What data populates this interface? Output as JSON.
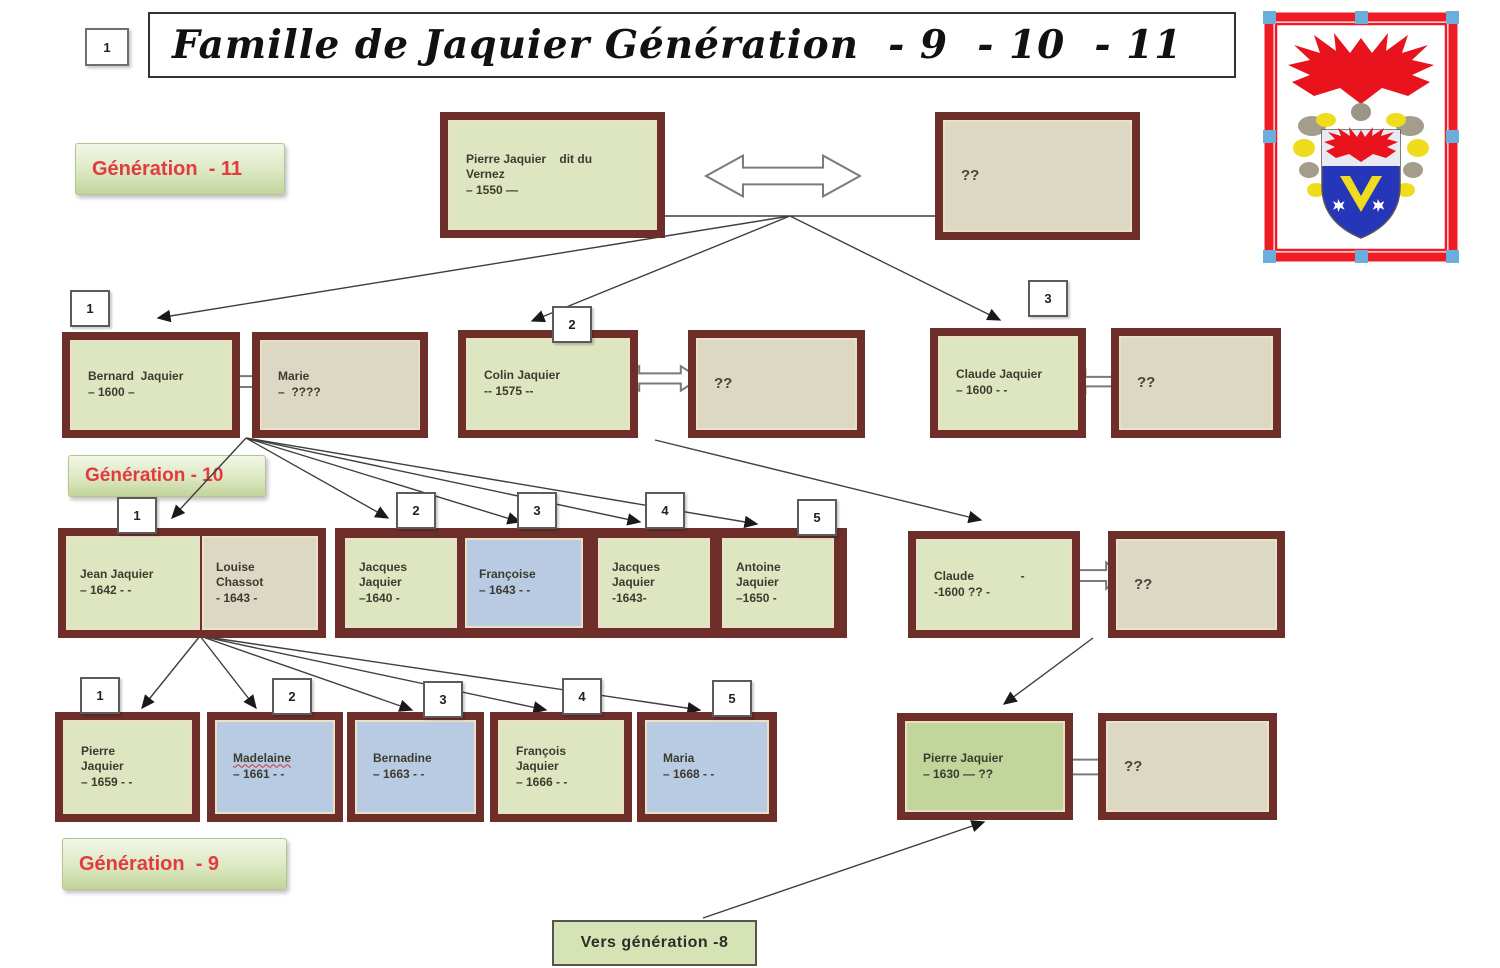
{
  "header": {
    "marker": "1",
    "title": "Famille de Jaquier Génération  - 9  - 10  - 11"
  },
  "generation_labels": {
    "gen11": "Génération  - 11",
    "gen10": "Génération - 10",
    "gen9": "Génération  - 9"
  },
  "footer": {
    "to_next_generation": "Vers génération -8"
  },
  "badges": {
    "gen10_couples": [
      "1",
      "2",
      "3"
    ],
    "gen10_children": [
      "1",
      "2",
      "3",
      "4",
      "5"
    ],
    "gen9_children": [
      "1",
      "2",
      "3",
      "4",
      "5"
    ]
  },
  "people": {
    "pierre_vernez": {
      "name": "Pierre Jaquier    dit du\nVernez",
      "dates": "– 1550 —"
    },
    "pierre_vernez_spouse": {
      "name": "??"
    },
    "bernard": {
      "name": "Bernard  Jaquier",
      "dates": "– 1600 –"
    },
    "marie": {
      "name": "Marie",
      "dates": "–  ????"
    },
    "colin": {
      "name": "Colin Jaquier",
      "dates": "-- 1575 --"
    },
    "colin_spouse": {
      "name": "??"
    },
    "claude": {
      "name": "Claude Jaquier",
      "dates": "– 1600 - -"
    },
    "claude_spouse": {
      "name": "??"
    },
    "jean": {
      "name": "Jean Jaquier",
      "dates": "– 1642 - -"
    },
    "louise": {
      "name": "Louise\nChassot",
      "dates": "- 1643 -"
    },
    "jacques1": {
      "name": "Jacques\nJaquier",
      "dates": "–1640 -"
    },
    "francoise": {
      "name": "Françoise",
      "dates": "– 1643 - -"
    },
    "jacques2": {
      "name": "Jacques\nJaquier",
      "dates": "-1643-"
    },
    "antoine": {
      "name": "Antoine\nJaquier",
      "dates": "–1650 -"
    },
    "claude2": {
      "name": "Claude              -",
      "dates": "-1600 ?? -"
    },
    "claude2_spouse": {
      "name": "??"
    },
    "pierre9": {
      "name": "Pierre\nJaquier",
      "dates": "– 1659 - -"
    },
    "madelaine": {
      "name": "Madelaine",
      "dates": "– 1661 - -"
    },
    "bernadine": {
      "name": "Bernadine",
      "dates": "– 1663 - -"
    },
    "francois": {
      "name": "François\nJaquier",
      "dates": "– 1666 - -"
    },
    "maria": {
      "name": "Maria",
      "dates": "– 1668 - -"
    },
    "pierre1630": {
      "name": "Pierre Jaquier",
      "dates": "– 1630 — ??"
    },
    "pierre1630_spouse": {
      "name": "??"
    }
  },
  "colors": {
    "box_border": "#6e2f2b",
    "male_fill": "#dde6c0",
    "male_dark_fill": "#c2d59a",
    "unknown_fill": "#ddd8c4",
    "female_fill": "#b9cbe2",
    "label_text": "#e23b3f",
    "crest_red": "#ee1c25",
    "crest_blue": "#2636b8",
    "crest_yellow": "#f5e01f"
  }
}
